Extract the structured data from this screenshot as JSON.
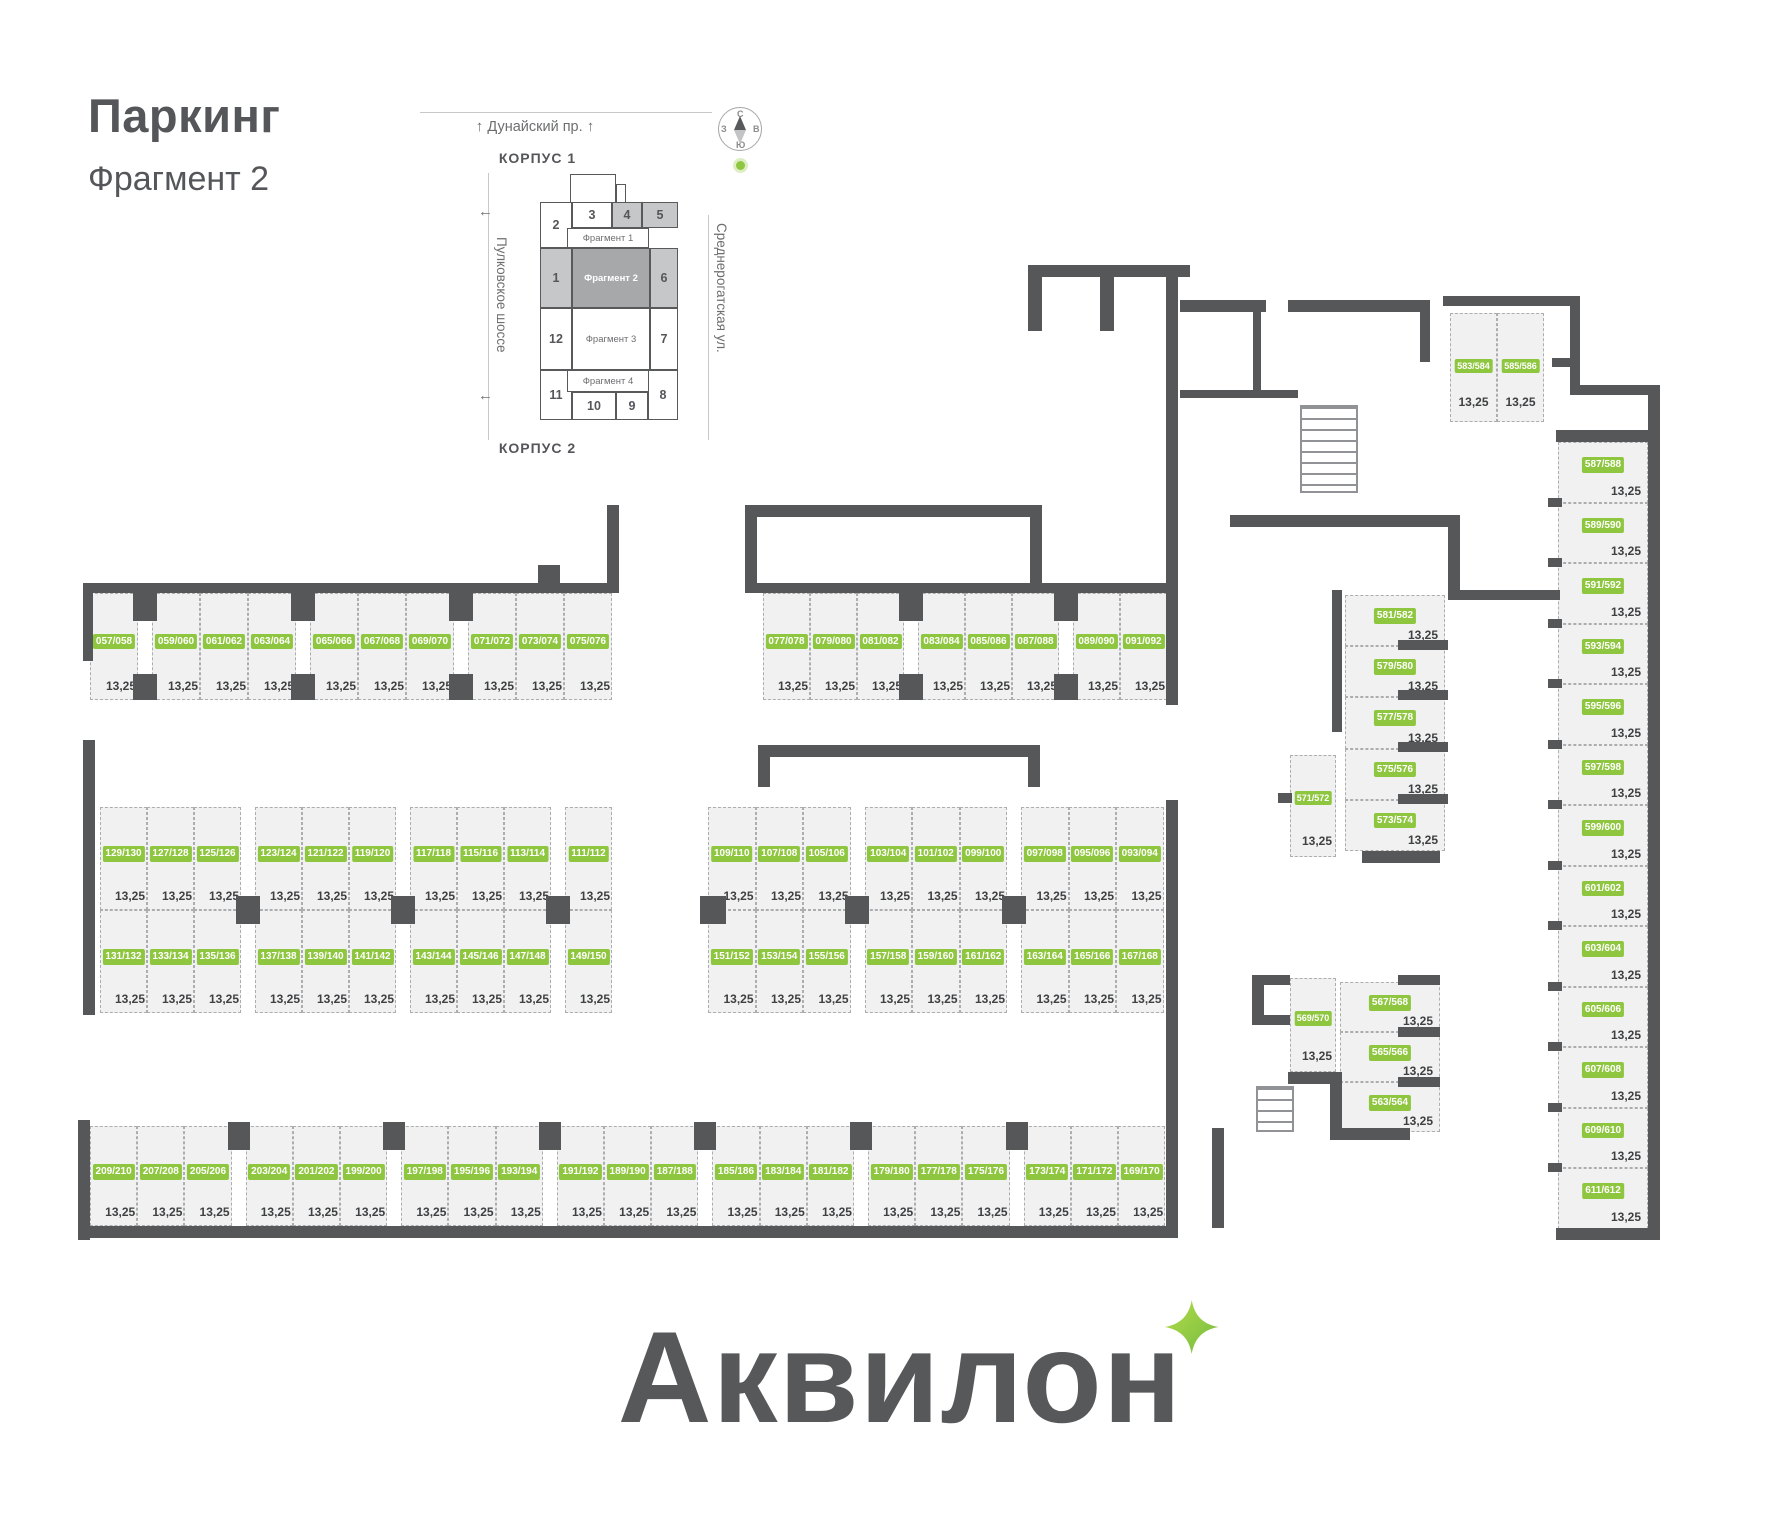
{
  "header": {
    "title": "Паркинг",
    "subtitle": "Фрагмент 2"
  },
  "minimap": {
    "street_top": "Дунайский пр.",
    "street_left": "Пулковское шоссе",
    "street_right": "Среднерогатская ул.",
    "arrow_up": "↑",
    "arrow_left": "←",
    "korpus_top": "КОРПУС 1",
    "korpus_bottom": "КОРПУС 2",
    "compass": {
      "n": "С",
      "s": "Ю",
      "w": "З",
      "e": "В"
    },
    "sections": [
      "1",
      "2",
      "3",
      "4",
      "5",
      "6",
      "7",
      "8",
      "9",
      "10",
      "11",
      "12"
    ],
    "fragments": [
      "Фрагмент 1",
      "Фрагмент 2",
      "Фрагмент 3",
      "Фрагмент 4"
    ],
    "active_fragment": "Фрагмент 2"
  },
  "plan": {
    "area_label": "13,25",
    "rows": {
      "top_left": [
        "057/058",
        "059/060",
        "061/062",
        "063/064",
        "065/066",
        "067/068",
        "069/070",
        "071/072",
        "073/074",
        "075/076"
      ],
      "top_right": [
        "077/078",
        "079/080",
        "081/082",
        "083/084",
        "085/086",
        "087/088",
        "089/090",
        "091/092"
      ],
      "mid_left_upper": [
        "129/130",
        "127/128",
        "125/126",
        "123/124",
        "121/122",
        "119/120",
        "117/118",
        "115/116",
        "113/114",
        "111/112"
      ],
      "mid_left_lower": [
        "131/132",
        "133/134",
        "135/136",
        "137/138",
        "139/140",
        "141/142",
        "143/144",
        "145/146",
        "147/148",
        "149/150"
      ],
      "mid_right_upper": [
        "109/110",
        "107/108",
        "105/106",
        "103/104",
        "101/102",
        "099/100",
        "097/098",
        "095/096",
        "093/094"
      ],
      "mid_right_lower": [
        "151/152",
        "153/154",
        "155/156",
        "157/158",
        "159/160",
        "161/162",
        "163/164",
        "165/166",
        "167/168"
      ],
      "bottom": [
        "209/210",
        "207/208",
        "205/206",
        "203/204",
        "201/202",
        "199/200",
        "197/198",
        "195/196",
        "193/194",
        "191/192",
        "189/190",
        "187/188",
        "185/186",
        "183/184",
        "181/182",
        "179/180",
        "177/178",
        "175/176",
        "173/174",
        "171/172",
        "169/170"
      ],
      "right_top_pair": [
        "583/584",
        "585/586"
      ],
      "right_column": [
        "587/588",
        "589/590",
        "591/592",
        "593/594",
        "595/596",
        "597/598",
        "599/600",
        "601/602",
        "603/604",
        "605/606",
        "607/608",
        "609/610",
        "611/612"
      ],
      "mid_stack": [
        "581/582",
        "579/580",
        "577/578",
        "575/576",
        "573/574"
      ],
      "vert_571": "571/572",
      "vert_569": "569/570",
      "lower_stack": [
        "567/568",
        "565/566",
        "563/564"
      ]
    }
  },
  "logo": {
    "text": "Аквилон"
  },
  "colors": {
    "accent_green": "#8fc640",
    "wall": "#565759",
    "text_dark": "#58595b",
    "space_fill": "#f1f1f2"
  }
}
